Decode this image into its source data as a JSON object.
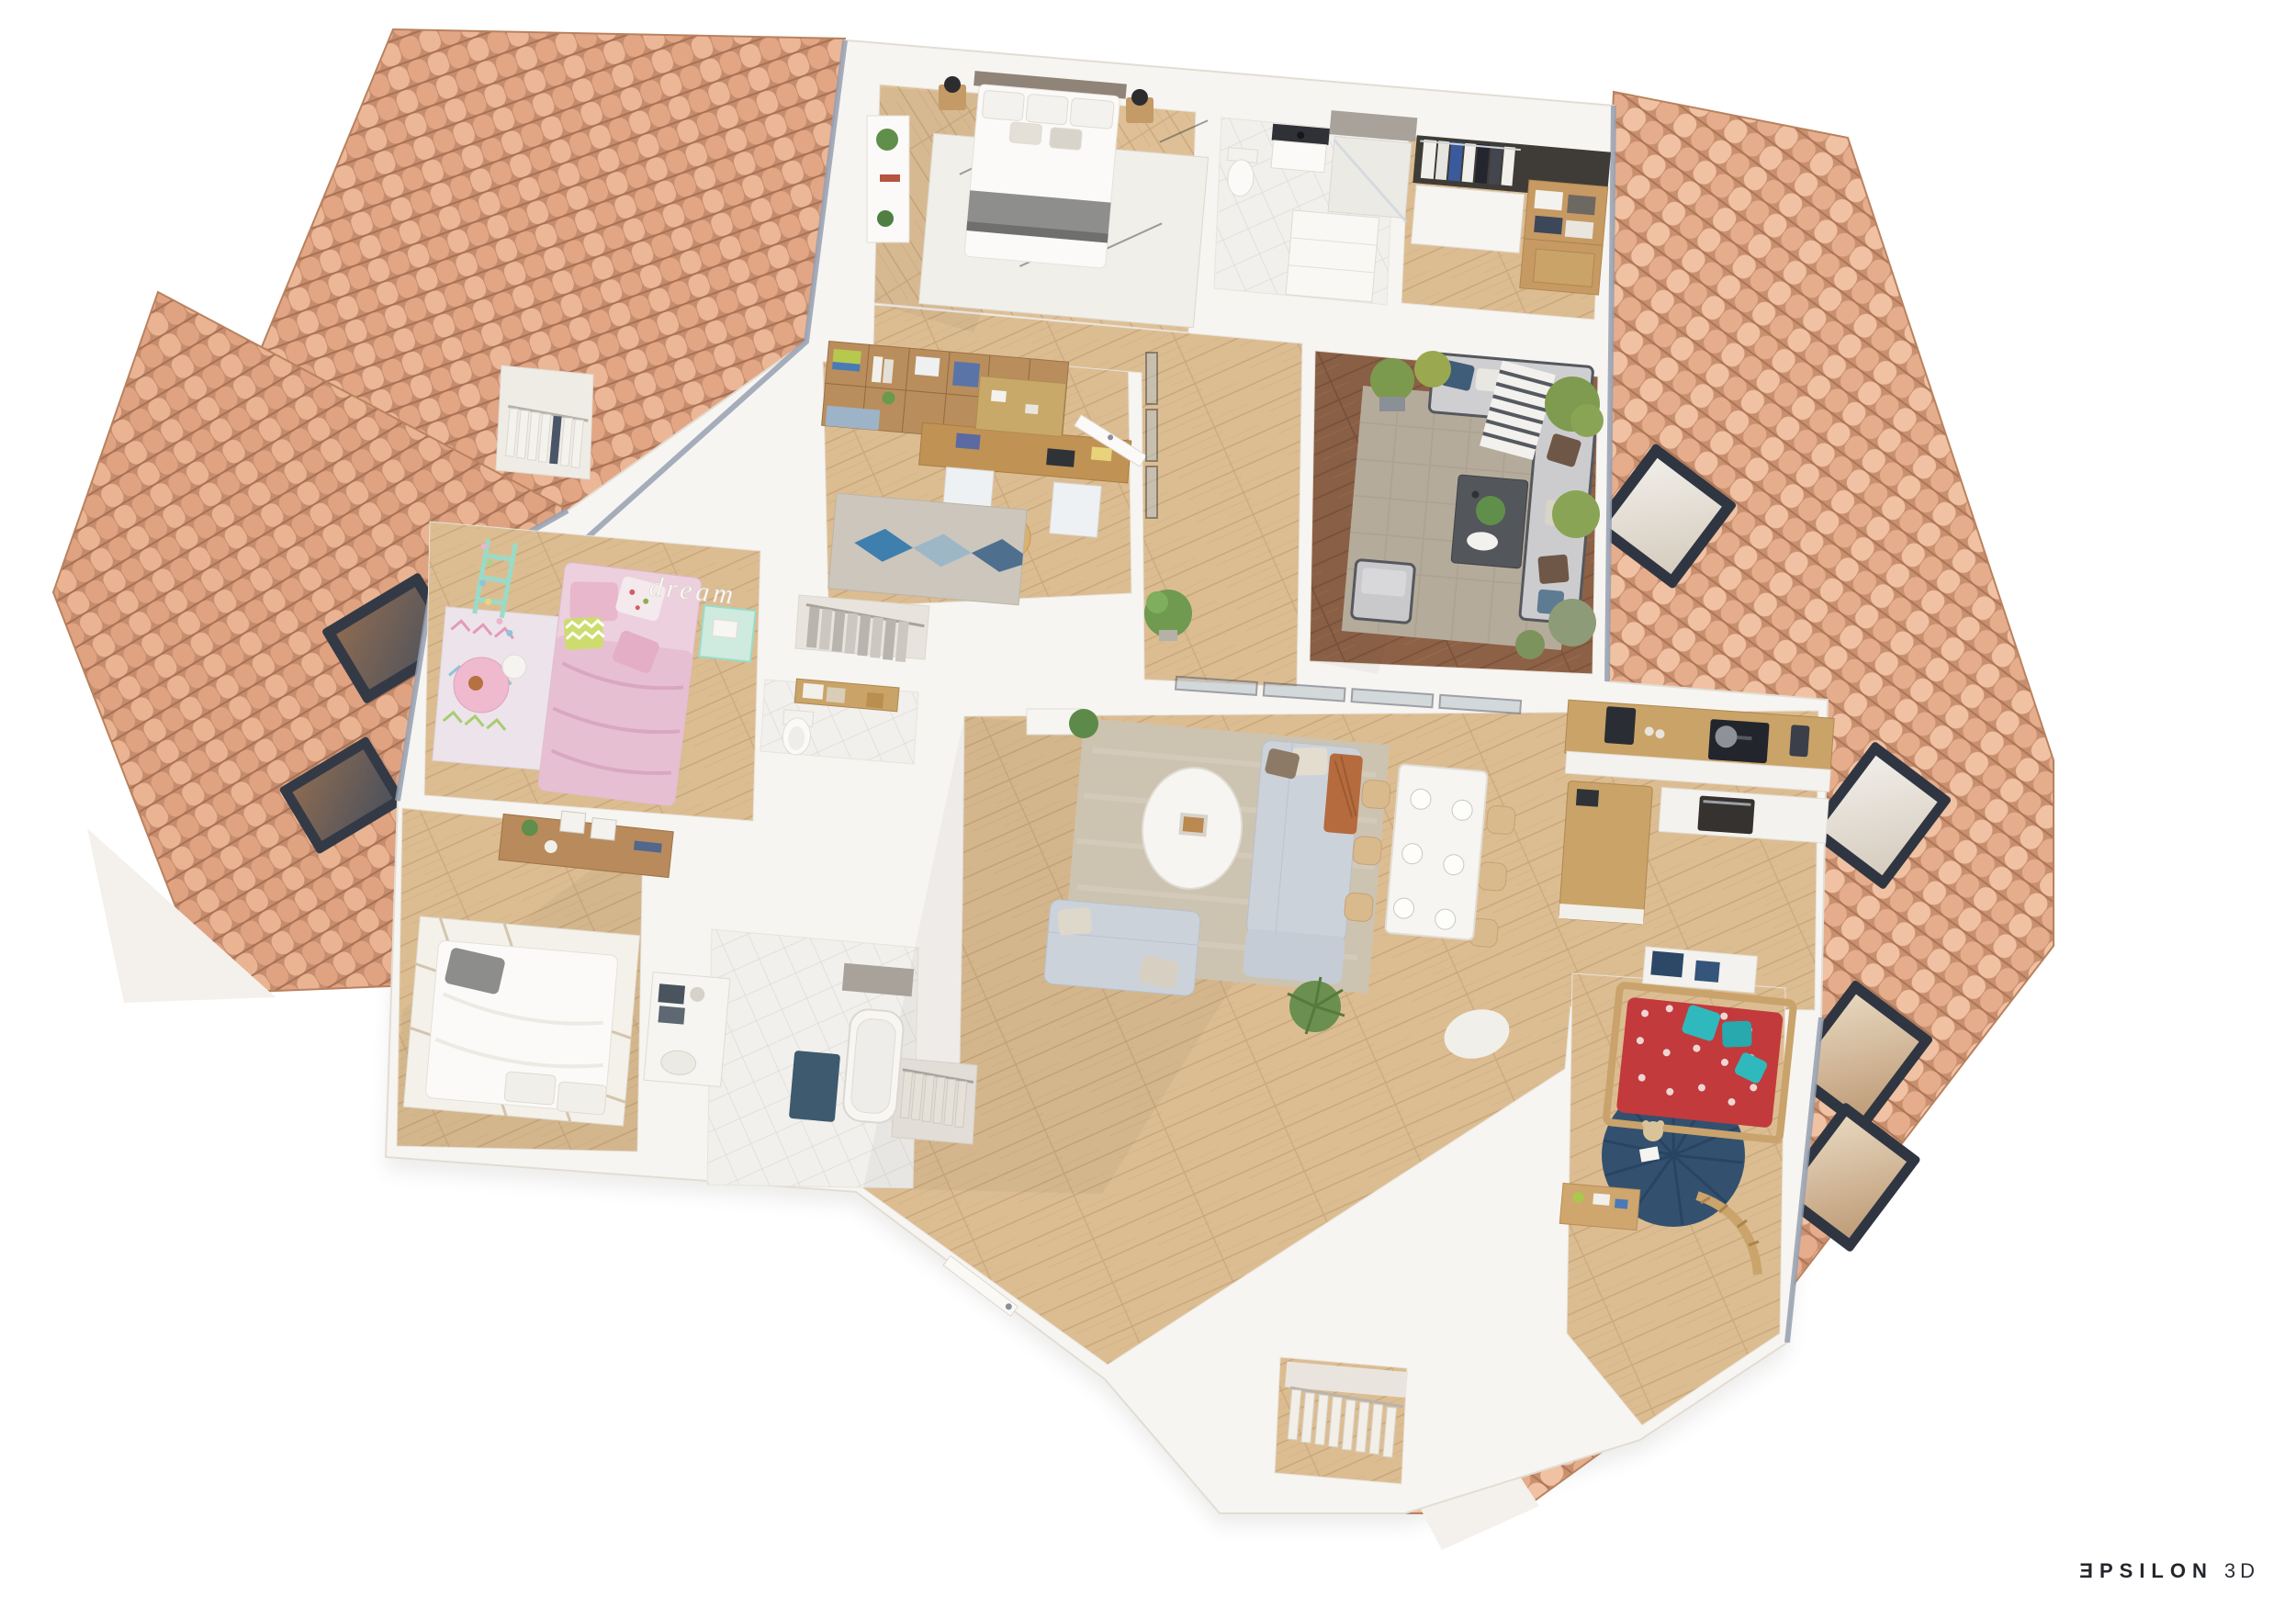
{
  "watermark": {
    "e": "Ǝ",
    "rest": "PSILON",
    "suffix": "3D"
  },
  "decor": {
    "wall_script": "dream"
  },
  "palette": {
    "background": "#ffffff",
    "roof_tile": "#e2a685",
    "roof_tile_light": "#ecb796",
    "roof_tile_shadow": "#a97155",
    "wall": "#f7f5f2",
    "wall_shade": "#e3dfd8",
    "roof_edge_fascia": "#97a0b2",
    "floor_wood": "#dcbd92",
    "floor_wood_line": "#c9a87c",
    "deck_wood": "#8d6146",
    "bath_tile": "#f1f0ed",
    "stone_wall": "#a8a29a",
    "sofa_gray": "#ccd2da",
    "rug_beige": "#cdc3b1",
    "rug_terrace": "#b5ab9b",
    "accent_terracotta": "#b56b3e",
    "accent_teal": "#2fb9bd",
    "accent_red": "#c23a3c",
    "accent_pink": "#e8c0d4",
    "accent_navy": "#33516f",
    "accent_mint": "#9adbc8",
    "skylight_frame": "#2f3642",
    "plant_green": "#6a8f4f",
    "watermark_text": "#24262b"
  },
  "scene": {
    "type": "3d-floor-plan-dollhouse-top-view",
    "floors_shown": 1,
    "skylight_count": 6,
    "rooms": [
      {
        "id": "master-bedroom",
        "features": [
          "double-bed",
          "taupe-headboard",
          "white-duvet",
          "gray-throw",
          "diamond-pattern-rug",
          "two-wood-nightstands",
          "black-lamps",
          "white-sideboard",
          "potted-plants"
        ]
      },
      {
        "id": "master-bathroom",
        "features": [
          "walk-in-shower",
          "stone-feature-wall",
          "toilet",
          "vanity-dark-top",
          "white-drawer-unit"
        ]
      },
      {
        "id": "walk-in-closet-top",
        "features": [
          "hanging-clothes",
          "white-sliding-doors",
          "wood-shelves-with-towels"
        ]
      },
      {
        "id": "office",
        "features": [
          "wood-wall-shelving",
          "desk",
          "cork-pinboard",
          "blue-cabinet-doors",
          "round-pouf",
          "blue-diamond-rug",
          "open-door"
        ]
      },
      {
        "id": "landing-hall",
        "features": [
          "glass-balustrade",
          "potted-plant"
        ]
      },
      {
        "id": "terrace-lounge",
        "features": [
          "dark-wood-deck",
          "woven-gray-rug",
          "outdoor-corner-sofa",
          "striped-throw",
          "armchair",
          "dark-coffee-table",
          "potted-shrubs"
        ]
      },
      {
        "id": "living-room",
        "features": [
          "two-gray-sofas",
          "terracotta-throw",
          "oval-white-coffee-table",
          "beige-rug",
          "sliding-glass-doors",
          "palm-plant",
          "sheepskin-rug"
        ]
      },
      {
        "id": "dining-area",
        "features": [
          "white-table",
          "six-place-settings",
          "six-light-wood-chairs"
        ]
      },
      {
        "id": "kitchen",
        "features": [
          "l-shaped-wood-counter",
          "island",
          "induction-hob",
          "pan",
          "coffee-machine",
          "blender",
          "built-in-oven"
        ]
      },
      {
        "id": "kids-bedroom-pink",
        "decor_text": "dream",
        "features": [
          "pink-single-bed",
          "chevron-pillow",
          "floral-pillow",
          "pastel-triangle-rug",
          "mint-ladder-shelf",
          "fairy-lights",
          "round-pink-table",
          "mint-desk"
        ]
      },
      {
        "id": "bedroom-white",
        "features": [
          "double-bed-white",
          "gray-cushion",
          "plaid-rug",
          "wood-console-desk",
          "picture-frames",
          "plant"
        ]
      },
      {
        "id": "family-bathroom",
        "features": [
          "bathtub",
          "stone-wall",
          "white-tile-floor",
          "vanity-with-towels",
          "navy-bath-mat"
        ]
      },
      {
        "id": "kids-bedroom-red",
        "features": [
          "house-frame-wood-bed",
          "red-patterned-duvet",
          "turquoise-pillows",
          "navy-round-rug",
          "teddy-bear",
          "toy-desk",
          "wooden-train-track",
          "navy-wall-desk"
        ]
      },
      {
        "id": "wc",
        "features": [
          "toilet",
          "wood-wall-shelf",
          "storage-boxes"
        ]
      },
      {
        "id": "linen-closet",
        "features": [
          "white-hangers"
        ]
      },
      {
        "id": "hall-wardrobe",
        "features": [
          "gray-hanging-clothes"
        ]
      },
      {
        "id": "entry-coat-closet",
        "features": [
          "hanging-coats"
        ]
      },
      {
        "id": "dressing-bottom",
        "features": [
          "white-hanging-clothes",
          "clothes-rail"
        ]
      },
      {
        "id": "entry",
        "features": [
          "front-door",
          "door-handle"
        ]
      }
    ]
  }
}
